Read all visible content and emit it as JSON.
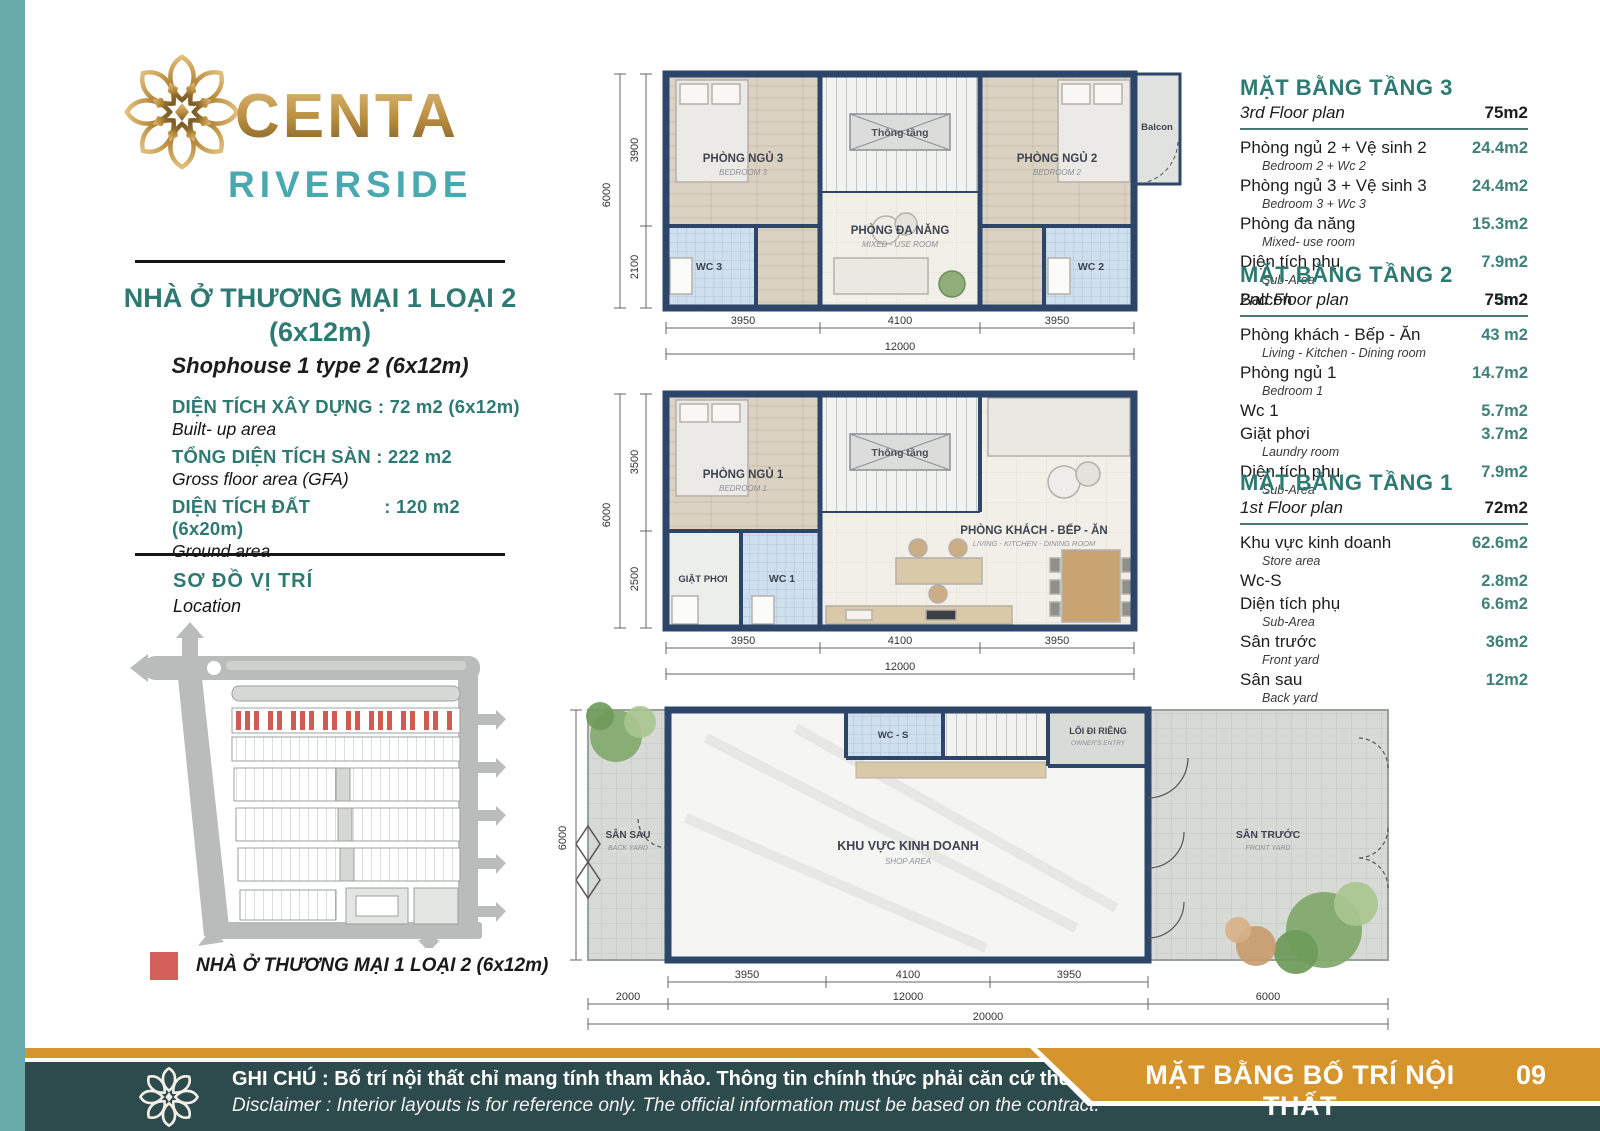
{
  "colors": {
    "accent_teal": "#2e7a72",
    "riverside_teal": "#48aab0",
    "gold": "#d6952c",
    "footer_bar": "#2d4a4c",
    "left_strip": "#68a9a9",
    "legend_red": "#d4605a",
    "wall_navy": "#2d4568",
    "value_teal": "#3f8179"
  },
  "brand": {
    "name": "CENTA",
    "sub": "RIVERSIDE"
  },
  "left": {
    "title1": "NHÀ Ở THƯƠNG MẠI 1 LOẠI 2",
    "title2": "(6x12m)",
    "subtitle": "Shophouse 1 type 2 (6x12m)",
    "specs": [
      {
        "label": "DIỆN TÍCH XÂY DỰNG",
        "value": ": 72 m2 (6x12m)",
        "sub": "Built- up area"
      },
      {
        "label": "TỔNG DIỆN TÍCH SÀN",
        "value": ": 222 m2",
        "sub": "Gross floor area (GFA)"
      },
      {
        "label": "DIỆN TÍCH ĐẤT",
        "value": ": 120 m2 (6x20m)",
        "sub": "Ground area"
      }
    ],
    "location_title": "SƠ ĐỒ VỊ TRÍ",
    "location_sub": "Location",
    "legend": "NHÀ Ở THƯƠNG MẠI 1 LOẠI 2 (6x12m)"
  },
  "tables": [
    {
      "title": "MẶT BẰNG TẦNG 3",
      "subtitle": "3rd Floor plan",
      "total": "75m2",
      "rows": [
        {
          "vi": "Phòng ngủ 2 + Vệ sinh 2",
          "en": "Bedroom 2 + Wc 2",
          "area": "24.4m2"
        },
        {
          "vi": "Phòng ngủ 3 + Vệ sinh 3",
          "en": "Bedroom 3 + Wc 3",
          "area": "24.4m2"
        },
        {
          "vi": "Phòng đa năng",
          "en": "Mixed- use room",
          "area": "15.3m2"
        },
        {
          "vi": "Diện tích phụ",
          "en": "Sub-Area",
          "area": "7.9m2"
        },
        {
          "vi": "Balcon",
          "en": "",
          "area": "3m2"
        }
      ]
    },
    {
      "title": "MẶT BẰNG TẦNG 2",
      "subtitle": "2nd Floor plan",
      "total": "75m2",
      "rows": [
        {
          "vi": "Phòng khách - Bếp - Ăn",
          "en": "Living - Kitchen - Dining room",
          "area": "43 m2"
        },
        {
          "vi": "Phòng ngủ 1",
          "en": "Bedroom 1",
          "area": "14.7m2"
        },
        {
          "vi": "Wc 1",
          "en": "",
          "area": "5.7m2"
        },
        {
          "vi": "Giặt phơi",
          "en": "Laundry room",
          "area": "3.7m2"
        },
        {
          "vi": "Diện tích phụ",
          "en": "Sub-Area",
          "area": "7.9m2"
        }
      ]
    },
    {
      "title": "MẶT BẰNG TẦNG 1",
      "subtitle": "1st Floor plan",
      "total": "72m2",
      "rows": [
        {
          "vi": "Khu vực kinh doanh",
          "en": "Store area",
          "area": "62.6m2"
        },
        {
          "vi": "Wc-S",
          "en": "",
          "area": "2.8m2"
        },
        {
          "vi": "Diện tích phụ",
          "en": "Sub-Area",
          "area": "6.6m2"
        },
        {
          "vi": "Sân trước",
          "en": "Front yard",
          "area": "36m2"
        },
        {
          "vi": "Sân sau",
          "en": "Back yard",
          "area": "12m2"
        }
      ]
    }
  ],
  "plans": {
    "floor3": {
      "rooms": {
        "bedroom3_vi": "PHÒNG NGỦ 3",
        "bedroom3_en": "BEDROOM 3",
        "wc3": "WC 3",
        "void": "Thông tầng",
        "multi_vi": "PHÒNG ĐA NĂNG",
        "multi_en": "MIXED - USE ROOM",
        "bedroom2_vi": "PHÒNG NGỦ 2",
        "bedroom2_en": "BEDROOM 2",
        "wc2": "WC 2",
        "balcony": "Balcon"
      },
      "dims": {
        "total_v": "6000",
        "v": [
          "3900",
          "2100"
        ],
        "h": [
          "3950",
          "4100",
          "3950"
        ],
        "total_h": "12000"
      }
    },
    "floor2": {
      "rooms": {
        "bedroom1_vi": "PHÒNG NGỦ 1",
        "bedroom1_en": "BEDROOM 1",
        "void": "Thông tầng",
        "living_vi": "PHÒNG KHÁCH - BẾP - ĂN",
        "living_en": "LIVING - KITCHEN - DINING ROOM",
        "laundry": "GIẶT PHƠI",
        "wc1": "WC 1"
      },
      "dims": {
        "total_v": "6000",
        "v": [
          "3500",
          "2500"
        ],
        "h": [
          "3950",
          "4100",
          "3950"
        ],
        "total_h": "12000"
      }
    },
    "floor1": {
      "rooms": {
        "backyard_vi": "SÂN SAU",
        "backyard_en": "BACK YARD",
        "shop_vi": "KHU VỰC KINH DOANH",
        "shop_en": "SHOP AREA",
        "wcs": "WC - S",
        "entry_vi": "LỐI ĐI RIÊNG",
        "entry_en": "OWNER'S ENTRY",
        "frontyard_vi": "SÂN TRƯỚC",
        "frontyard_en": "FRONT YARD"
      },
      "dims": {
        "total_v": "6000",
        "h": [
          "3950",
          "4100",
          "3950"
        ],
        "mid": [
          "2000",
          "12000",
          "6000"
        ],
        "total_h": "20000"
      }
    }
  },
  "footer": {
    "note_vi": "GHI CHÚ : Bố trí nội thất chỉ mang tính tham khảo. Thông tin chính thức phải căn cứ theo hợp đồng.",
    "note_en": "Disclaimer : Interior layouts is for reference only. The official information must be based on the contract.",
    "banner": "MẶT BẰNG BỐ TRÍ NỘI THẤT",
    "page": "09"
  }
}
